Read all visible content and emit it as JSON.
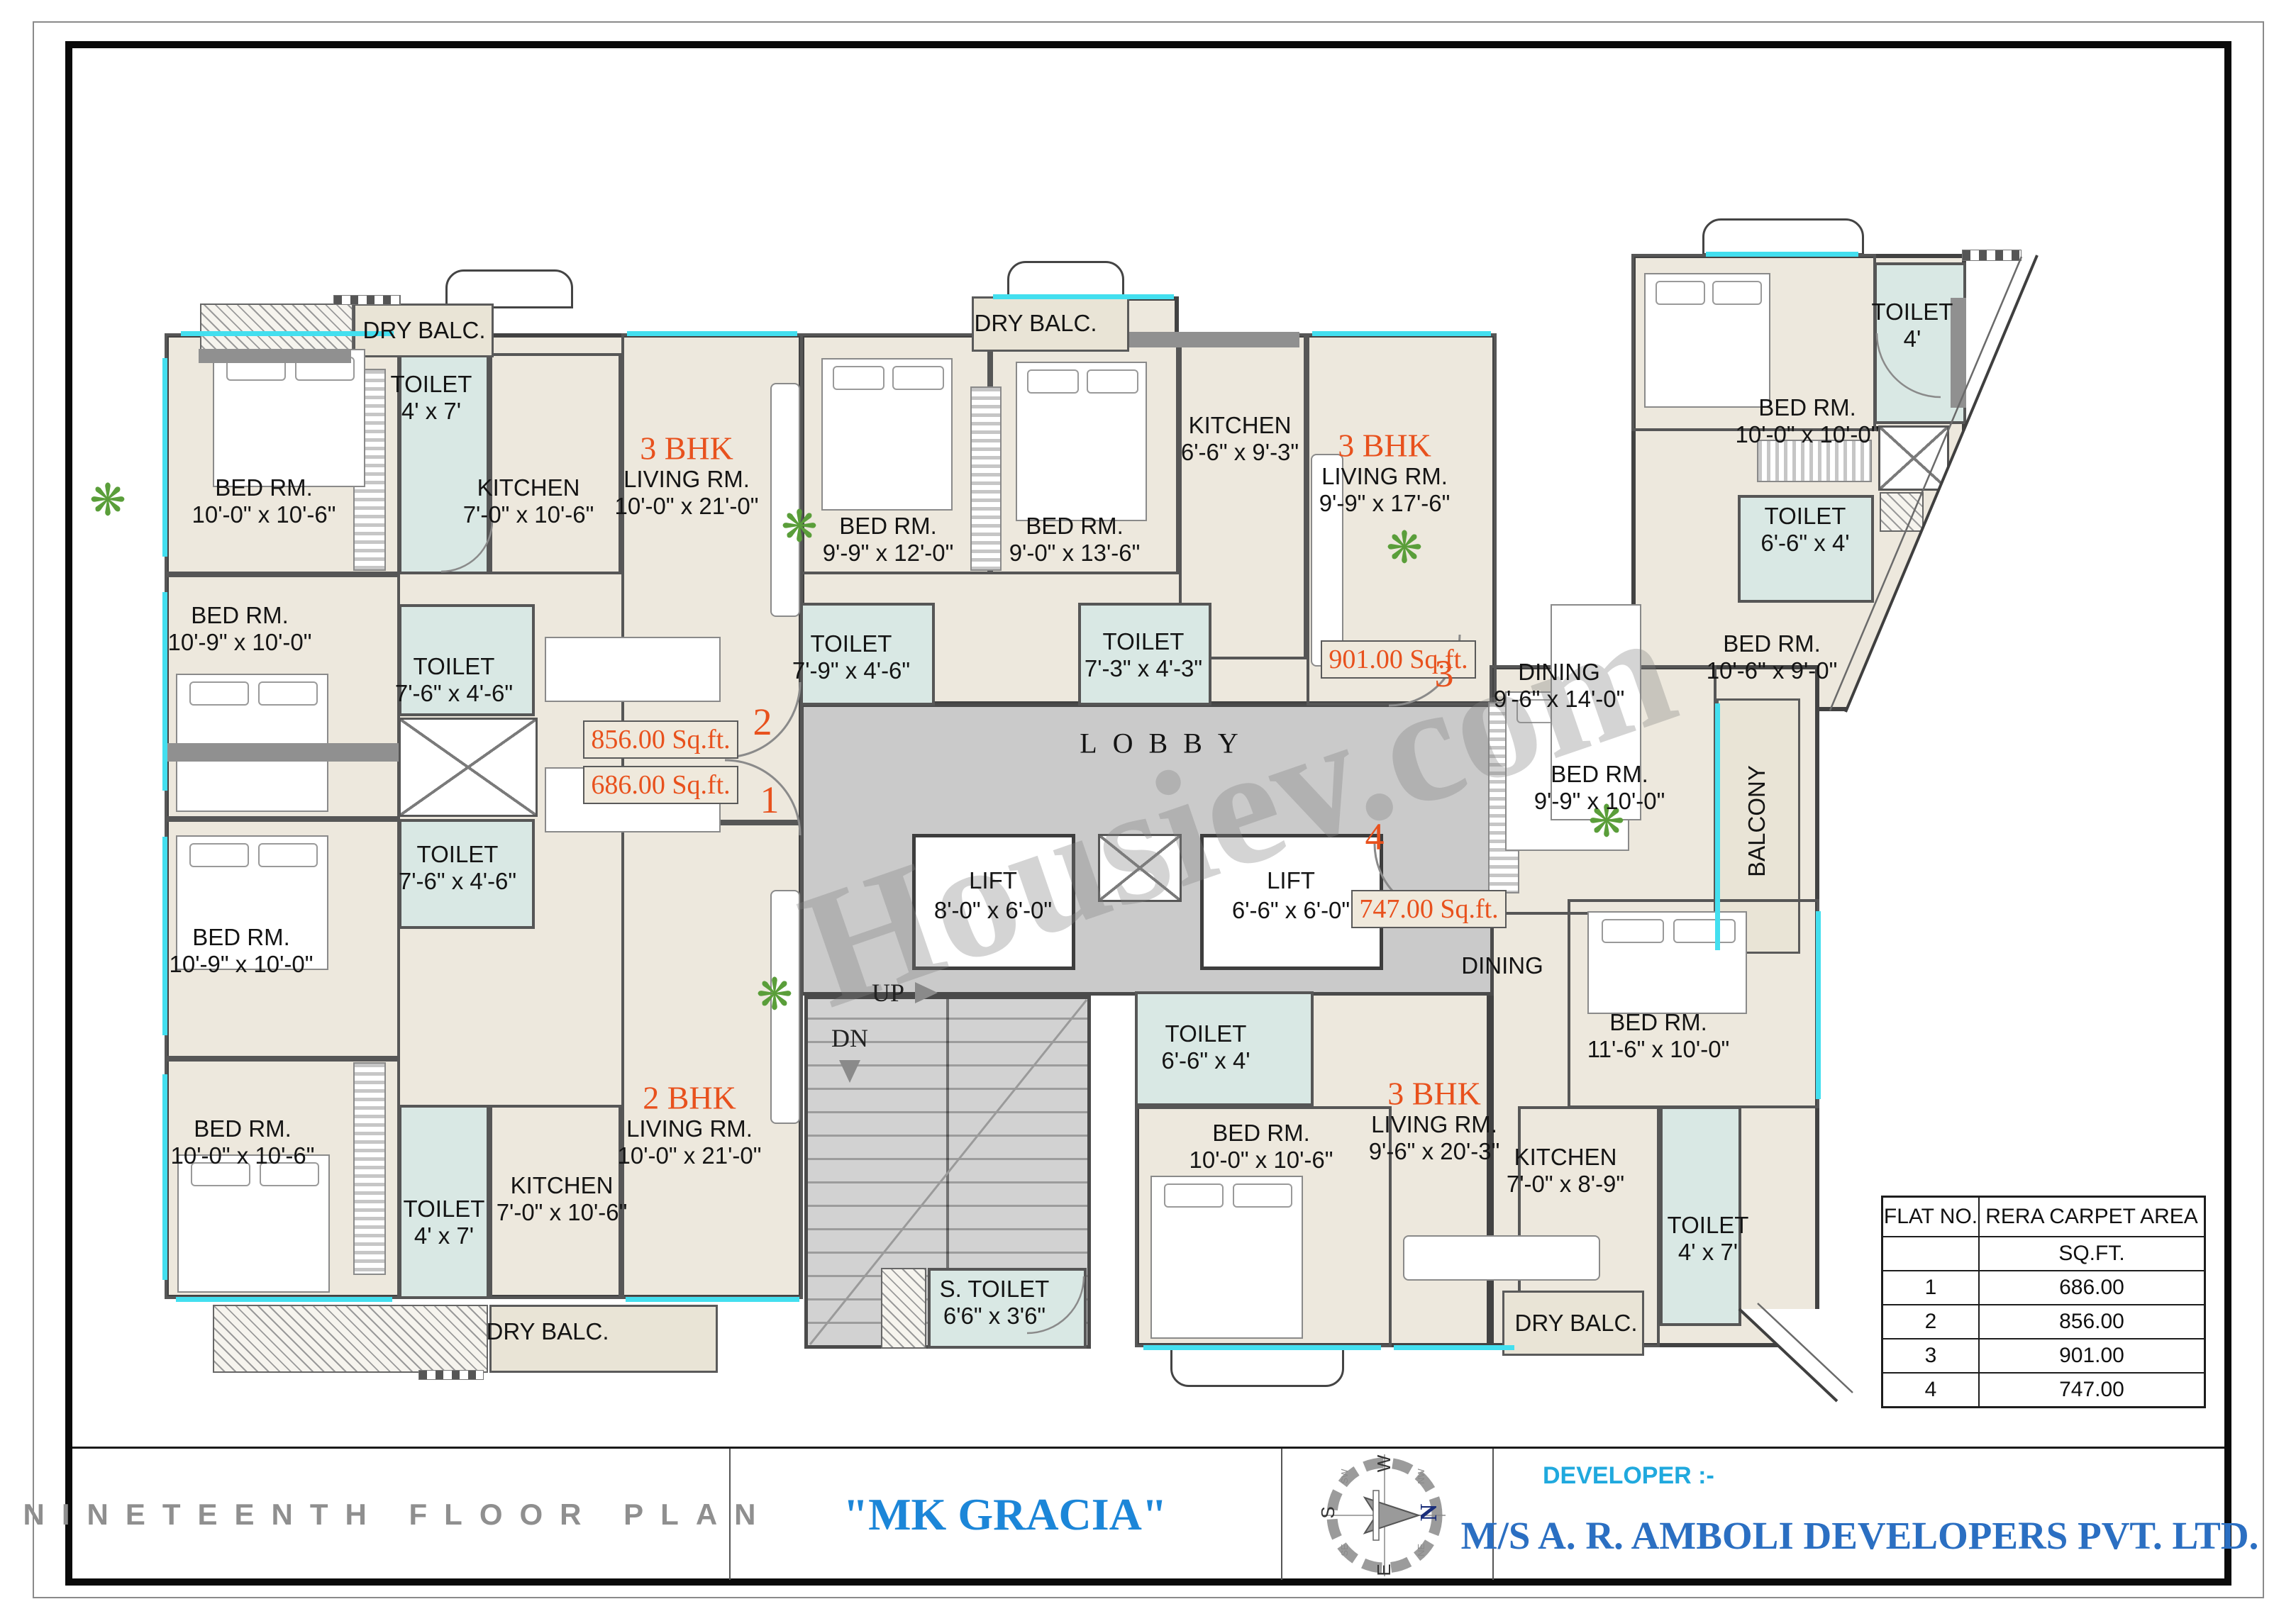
{
  "watermark": "Housiev.com",
  "plan": {
    "rooms": {
      "dry_balc_tl": {
        "name": "DRY BALC."
      },
      "toilet_tl": {
        "name": "TOILET",
        "dims": "4' x 7'"
      },
      "bed_f2a": {
        "name": "BED RM.",
        "dims": "10'-0\" x 10'-6\""
      },
      "kitchen_f2": {
        "name": "KITCHEN",
        "dims": "7'-0\" x 10'-6\""
      },
      "bed_f2b": {
        "name": "BED RM.",
        "dims": "10'-9\" x 10'-0\""
      },
      "toilet_f2b": {
        "name": "TOILET",
        "dims": "7'-6\" x 4'-6\""
      },
      "bed_f3a": {
        "name": "BED RM.",
        "dims": "9'-9\" x 12'-0\""
      },
      "bed_f3b": {
        "name": "BED RM.",
        "dims": "9'-0\" x 13'-6\""
      },
      "dry_balc_tm": {
        "name": "DRY BALC."
      },
      "kitchen_f3": {
        "name": "KITCHEN",
        "dims": "6'-6\" x 9'-3\""
      },
      "toilet_f3a": {
        "name": "TOILET",
        "dims": "7'-9\" x 4'-6\""
      },
      "toilet_f3b": {
        "name": "TOILET",
        "dims": "7'-3\" x 4'-3\""
      },
      "dining_f3": {
        "name": "DINING",
        "dims": "9'-6\" x 14'-0\""
      },
      "bed_tr": {
        "name": "BED RM.",
        "dims": "10'-0\" x 10'-0\""
      },
      "toilet_tr": {
        "name": "TOILET",
        "dims": "4'"
      },
      "toilet_r": {
        "name": "TOILET",
        "dims": "6'-6\" x 4'"
      },
      "bed_r": {
        "name": "BED RM.",
        "dims": "10'-6\" x 9'-0\""
      },
      "balcony": {
        "name": "BALCONY"
      },
      "bed_f4a": {
        "name": "BED RM.",
        "dims": "9'-9\" x 10'-0\""
      },
      "dining_f4": {
        "name": "DINING"
      },
      "bed_f4b": {
        "name": "BED RM.",
        "dims": "11'-6\" x 10'-0\""
      },
      "kitchen_f4": {
        "name": "KITCHEN",
        "dims": "7'-0\" x 8'-9\""
      },
      "toilet_f4a": {
        "name": "TOILET",
        "dims": "4' x 7'"
      },
      "toilet_f4b": {
        "name": "TOILET",
        "dims": "6'-6\" x 4'"
      },
      "bed_f4c": {
        "name": "BED RM.",
        "dims": "10'-0\" x 10'-6\""
      },
      "dry_balc_f4": {
        "name": "DRY BALC."
      },
      "bed_f1a": {
        "name": "BED RM.",
        "dims": "10'-9\" x 10'-0\""
      },
      "toilet_f1a": {
        "name": "TOILET",
        "dims": "7'-6\" x 4'-6\""
      },
      "bed_f1b": {
        "name": "BED RM.",
        "dims": "10'-0\" x 10'-6\""
      },
      "toilet_f1b": {
        "name": "TOILET",
        "dims": "4' x 7'"
      },
      "kitchen_f1": {
        "name": "KITCHEN",
        "dims": "7'-0\" x 10'-6\""
      },
      "s_toilet": {
        "name": "S. TOILET",
        "dims": "6'6\" x 3'6\""
      },
      "dry_balc_f1": {
        "name": "DRY BALC."
      }
    },
    "flats": {
      "f2": {
        "type": "3 BHK",
        "room": "LIVING RM.",
        "dims": "10'-0\" x 21'-0\""
      },
      "f3": {
        "type": "3 BHK",
        "room": "LIVING RM.",
        "dims": "9'-9\" x 17'-6\""
      },
      "f1": {
        "type": "2 BHK",
        "room": "LIVING RM.",
        "dims": "10'-0\" x 21'-0\""
      },
      "f4": {
        "type": "3 BHK",
        "room": "LIVING RM.",
        "dims": "9'-6\" x 20'-3\""
      }
    },
    "core": {
      "lobby": "LOBBY",
      "lift1": {
        "name": "LIFT",
        "dims": "8'-0\" x 6'-0\""
      },
      "lift2": {
        "name": "LIFT",
        "dims": "6'-6\" x 6'-0\""
      },
      "up": "UP",
      "dn": "DN"
    },
    "area_boxes": {
      "a856": "856.00 Sq.ft.",
      "a686": "686.00 Sq.ft.",
      "a901": "901.00 Sq.ft.",
      "a747": "747.00 Sq.ft."
    },
    "markers": {
      "m1": "1",
      "m2": "2",
      "m3": "3",
      "m4": "4"
    }
  },
  "area_table": {
    "headers": [
      "FLAT NO.",
      "RERA CARPET AREA"
    ],
    "unit_row": "SQ.FT.",
    "rows": [
      [
        "1",
        "686.00"
      ],
      [
        "2",
        "856.00"
      ],
      [
        "3",
        "901.00"
      ],
      [
        "4",
        "747.00"
      ]
    ]
  },
  "footer": {
    "plan_title": "NINETEENTH FLOOR PLAN",
    "project_name": "\"MK GRACIA\"",
    "developer_label": "DEVELOPER :-",
    "developer_name": "M/S A. R. AMBOLI DEVELOPERS PVT. LTD.",
    "compass": {
      "n": "N",
      "s": "S",
      "e": "E",
      "w": "W",
      "nw": "NW",
      "ne": "NE",
      "se": "SE",
      "sw": "SW"
    }
  }
}
